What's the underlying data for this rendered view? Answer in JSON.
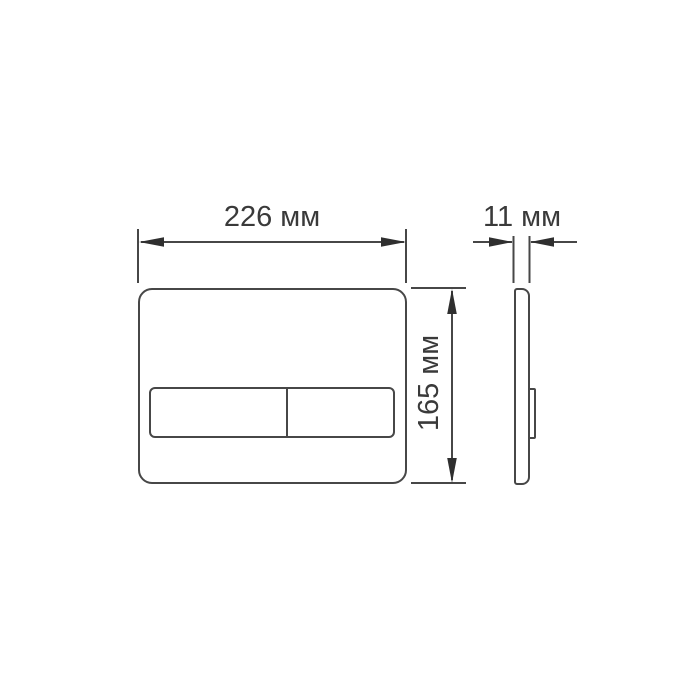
{
  "drawing": {
    "type": "technical-dimension-drawing",
    "subject": "toilet-flush-plate",
    "unit": "мм",
    "dimensions": {
      "width": {
        "value": 226,
        "label": "226 мм"
      },
      "height": {
        "value": 165,
        "label": "165 мм"
      },
      "depth": {
        "value": 11,
        "label": "11 мм"
      }
    },
    "views": {
      "front": "flush plate with dual-button bar",
      "side": "thin profile with protruding button"
    },
    "colors": {
      "line": "#474747",
      "arrow": "#2f2f2f",
      "text": "#3a3a3a",
      "background": "#ffffff"
    }
  }
}
